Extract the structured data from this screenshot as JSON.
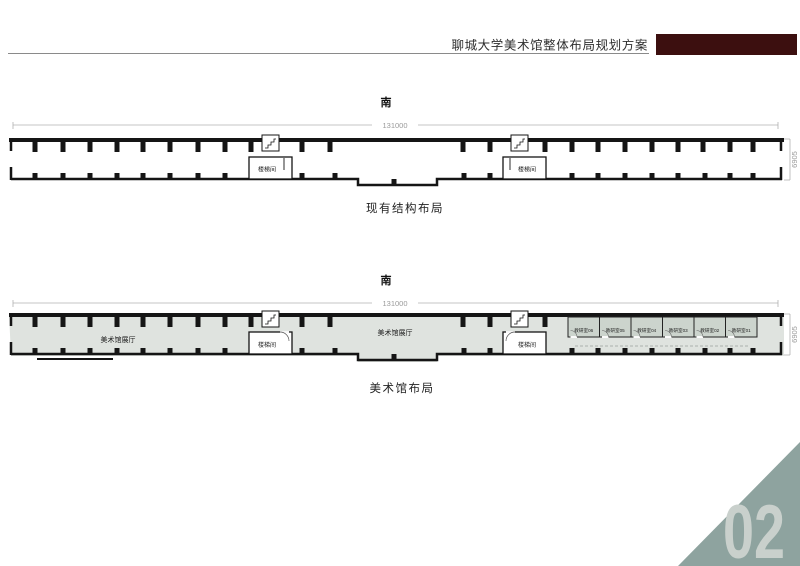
{
  "header": {
    "title": "聊城大学美术馆整体布局规划方案"
  },
  "plan_existing": {
    "orientation_label": "南",
    "dim_width": "131000",
    "dim_height": "6905",
    "stairwell_1": "楼梯间",
    "stairwell_2": "楼梯间",
    "caption": "现有结构布局"
  },
  "plan_museum": {
    "orientation_label": "南",
    "dim_width": "131000",
    "dim_height": "6905",
    "hall_label_1": "美术馆展厅",
    "hall_label_2": "美术馆展厅",
    "stairwell_1": "楼梯间",
    "stairwell_2": "楼梯间",
    "classrooms": [
      "教研室06",
      "教研室05",
      "教研室04",
      "教研室03",
      "教研室02",
      "教研室01"
    ],
    "caption": "美术馆布局"
  },
  "footer": {
    "page_number": "02"
  },
  "colors": {
    "accent": "#3c0f0f",
    "plan_fill": "#dfe3df",
    "classroom_fill": "#ccd4cd",
    "footer_triangle": "#8ea39f",
    "page_number_color": "#c9d0cc"
  }
}
